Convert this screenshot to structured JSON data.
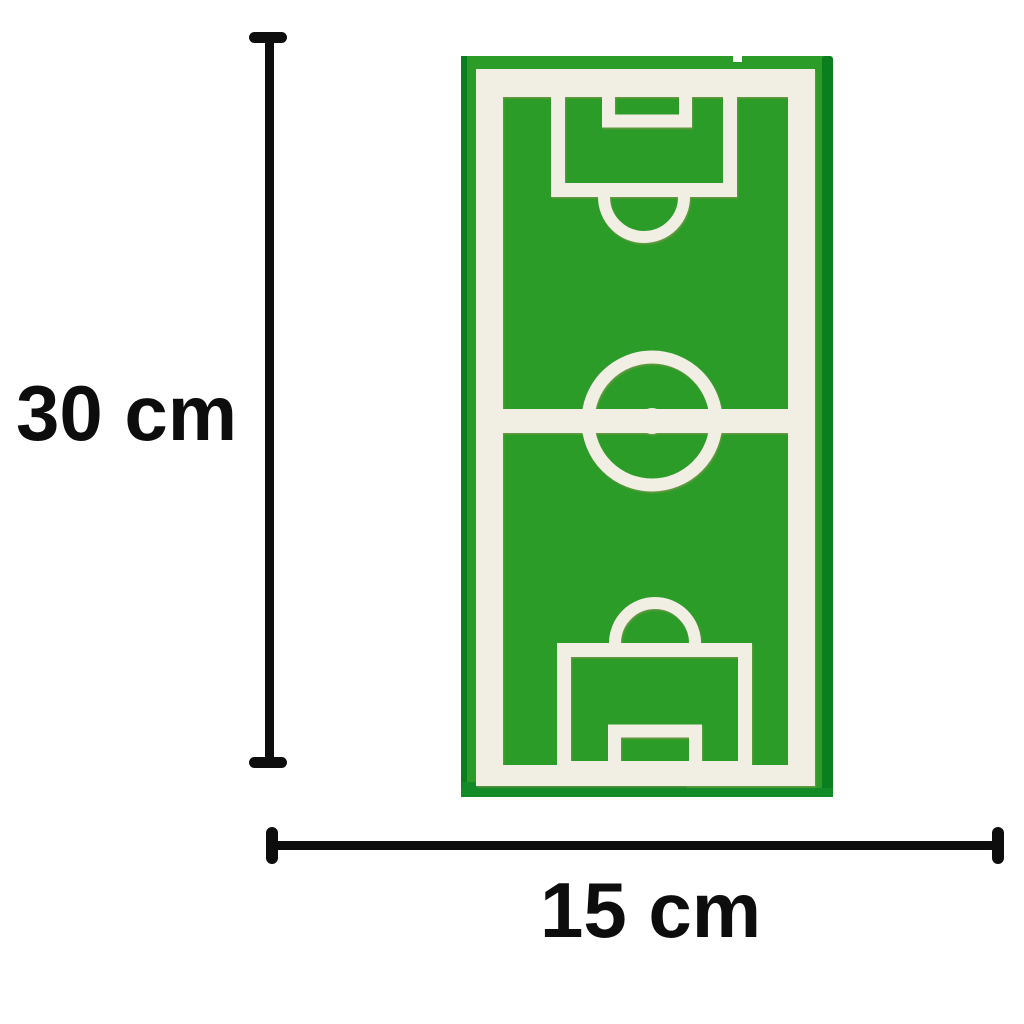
{
  "canvas": {
    "background_color": "#ffffff"
  },
  "annotations": {
    "height_label": "30 cm",
    "width_label": "15 cm",
    "line_color": "#0d0d0d",
    "text_color": "#0d0d0d"
  },
  "field": {
    "name": "soccer-field-board",
    "colors": {
      "board": "#2b9c27",
      "edge_dark": "#0b7e20",
      "edge_bottom": "#128a28",
      "lines": "#f1eee4",
      "line_shadow": "#a99060"
    }
  }
}
